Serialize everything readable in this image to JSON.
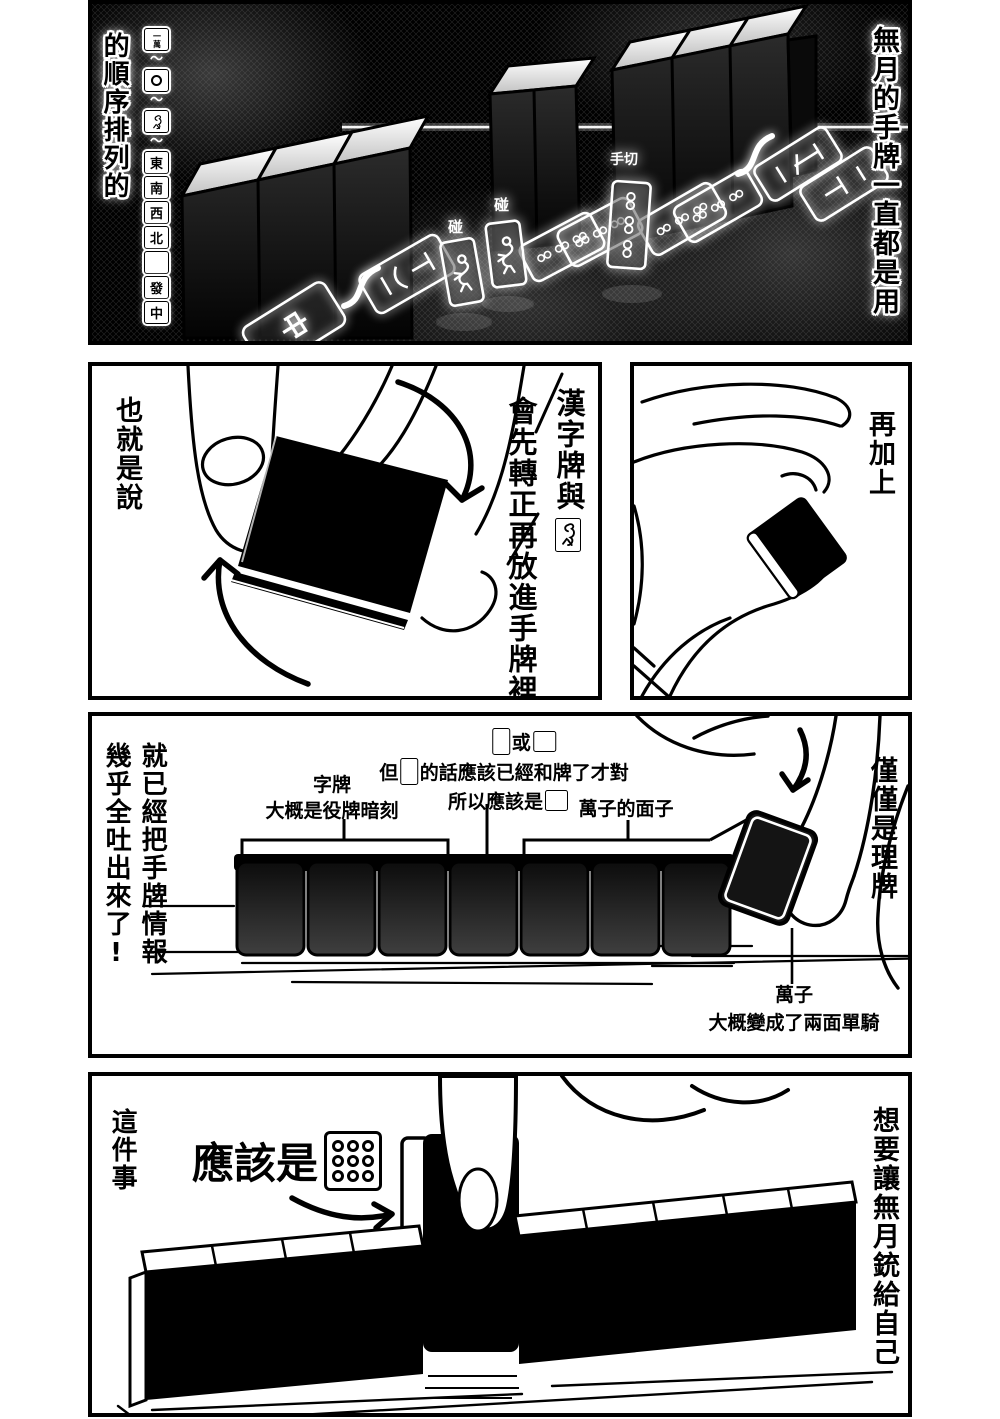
{
  "panel1": {
    "right_text": "無月的手牌一直都是用",
    "left_text": "的順序排列的",
    "strip": {
      "man": "一萬",
      "tilde": "〜",
      "east": "東",
      "south": "南",
      "west": "西",
      "north": "北",
      "green": "發",
      "red": "中"
    },
    "pon_left": "碰",
    "pon_right": "碰",
    "tegiri": "手切",
    "flat_center": "中"
  },
  "panel2_left": {
    "side_text": "也就是說",
    "bubble_line1": "漢字牌與",
    "bubble_line2": "會先轉正再放進手牌裡!"
  },
  "panel2_right": {
    "side_text": "再加上"
  },
  "panel3": {
    "side_text_right": "就已經把手牌情報",
    "side_text_left": "幾乎全吐出來了!",
    "right_text": "僅僅是理牌",
    "top_or": "或",
    "but_pre": "但",
    "but_post": "的話應該已經和牌了才對",
    "so_pre": "所以應該是",
    "honor_label": "字牌",
    "honor_sub": "大概是役牌暗刻",
    "manzu_label": "萬子的面子",
    "manzu_bottom": "萬子",
    "manzu_bottom_sub": "大概變成了兩面單騎"
  },
  "panel4": {
    "side_text_left": "這件事",
    "callout": "應該是",
    "side_text_right": "想要讓無月銃給自己"
  },
  "colors": {
    "ink": "#000000",
    "paper": "#ffffff",
    "tile_back_dark": "#111111"
  }
}
